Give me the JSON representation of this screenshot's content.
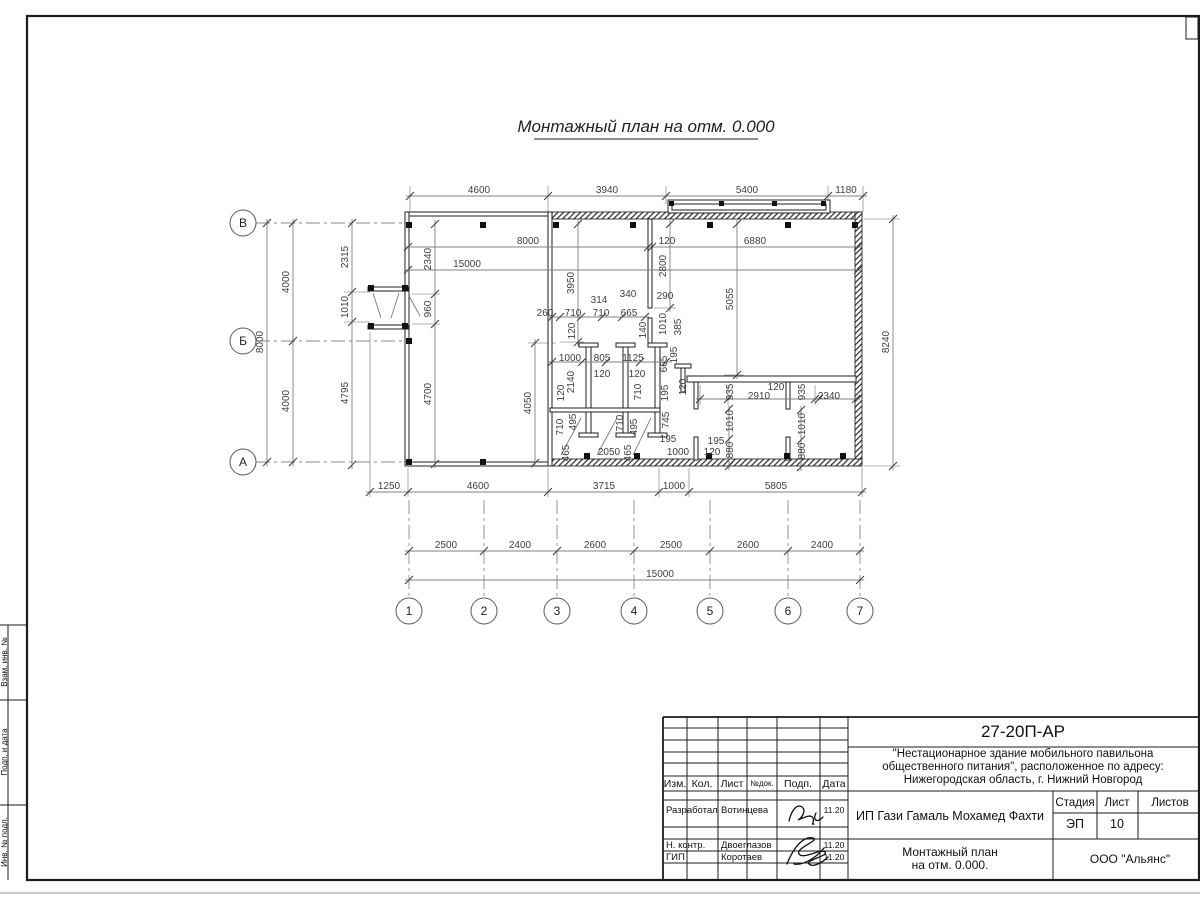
{
  "plan": {
    "title": "Монтажный план на отм. 0.000",
    "row_axes": [
      {
        "label": "В",
        "y": 223
      },
      {
        "label": "Б",
        "y": 341
      },
      {
        "label": "А",
        "y": 462
      }
    ],
    "col_axes": [
      {
        "label": "1",
        "x": 409
      },
      {
        "label": "2",
        "x": 484
      },
      {
        "label": "3",
        "x": 557
      },
      {
        "label": "4",
        "x": 634
      },
      {
        "label": "5",
        "x": 710
      },
      {
        "label": "6",
        "x": 788
      },
      {
        "label": "7",
        "x": 860
      }
    ],
    "h_chains": [
      {
        "y": 196,
        "ticks": [
          410,
          548,
          666,
          828,
          863
        ],
        "labels": [
          {
            "t": "4600",
            "x": 479
          },
          {
            "t": "3940",
            "x": 607
          },
          {
            "t": "5400",
            "x": 747
          },
          {
            "t": "1180",
            "x": 846
          }
        ]
      },
      {
        "y": 247,
        "ticks": [
          408,
          648,
          652,
          858
        ],
        "labels": [
          {
            "t": "8000",
            "x": 528
          },
          {
            "t": "120",
            "x": 667
          },
          {
            "t": "6880",
            "x": 755
          }
        ]
      },
      {
        "y": 270,
        "ticks": [
          408,
          858
        ],
        "labels": [
          {
            "t": "15000",
            "x": 467
          }
        ]
      },
      {
        "y": 317,
        "ticks": [
          552,
          560,
          581,
          602,
          622,
          645
        ],
        "labels": []
      },
      {
        "y": 362,
        "ticks": [
          552,
          582,
          606,
          640,
          666
        ],
        "labels": []
      },
      {
        "y": 399,
        "ticks": [
          700,
          728,
          815,
          819,
          856
        ],
        "labels": []
      },
      {
        "y": 492,
        "ticks": [
          370,
          408,
          548,
          659,
          689,
          862
        ],
        "labels": [
          {
            "t": "1250",
            "x": 389
          },
          {
            "t": "4600",
            "x": 478
          },
          {
            "t": "3715",
            "x": 604
          },
          {
            "t": "1000",
            "x": 674
          },
          {
            "t": "5805",
            "x": 776
          }
        ]
      },
      {
        "y": 551,
        "ticks": [
          409,
          484,
          557,
          634,
          710,
          788,
          860
        ],
        "labels": [
          {
            "t": "2500",
            "x": 446
          },
          {
            "t": "2400",
            "x": 520
          },
          {
            "t": "2600",
            "x": 595
          },
          {
            "t": "2500",
            "x": 671
          },
          {
            "t": "2600",
            "x": 748
          },
          {
            "t": "2400",
            "x": 822
          }
        ]
      },
      {
        "y": 580,
        "ticks": [
          409,
          860
        ],
        "labels": [
          {
            "t": "15000",
            "x": 660
          }
        ]
      }
    ],
    "v_chains": [
      {
        "x": 267,
        "ticks": [
          223,
          462
        ],
        "labels": [
          {
            "t": "8000",
            "y": 342
          }
        ]
      },
      {
        "x": 293,
        "ticks": [
          223,
          341,
          462
        ],
        "labels": [
          {
            "t": "4000",
            "y": 282
          },
          {
            "t": "4000",
            "y": 401
          }
        ]
      },
      {
        "x": 352,
        "ticks": [
          223,
          292,
          322,
          465
        ],
        "labels": [
          {
            "t": "2315",
            "y": 257
          },
          {
            "t": "1010",
            "y": 307
          },
          {
            "t": "4795",
            "y": 393
          }
        ]
      },
      {
        "x": 435,
        "ticks": [
          224,
          294,
          324,
          464
        ],
        "labels": [
          {
            "t": "2340",
            "y": 259
          },
          {
            "t": "960",
            "y": 309
          },
          {
            "t": "4700",
            "y": 394
          }
        ]
      },
      {
        "x": 578,
        "ticks": [
          224,
          342
        ],
        "labels": [
          {
            "t": "3950",
            "y": 283
          }
        ]
      },
      {
        "x": 535,
        "ticks": [
          343,
          463
        ],
        "labels": [
          {
            "t": "4050",
            "y": 403
          }
        ]
      },
      {
        "x": 670,
        "ticks": [
          224,
          308
        ],
        "labels": [
          {
            "t": "2800",
            "y": 266
          }
        ]
      },
      {
        "x": 737,
        "ticks": [
          224,
          375
        ],
        "labels": [
          {
            "t": "5055",
            "y": 299
          }
        ]
      },
      {
        "x": 893,
        "ticks": [
          219,
          466
        ],
        "labels": [
          {
            "t": "8240",
            "y": 342
          }
        ]
      },
      {
        "x": 729,
        "ticks": [
          409,
          439,
          466
        ],
        "labels": []
      },
      {
        "x": 801,
        "ticks": [
          410,
          440,
          467
        ],
        "labels": []
      }
    ],
    "labels": [
      {
        "t": "260",
        "x": 545,
        "y": 313
      },
      {
        "t": "710",
        "x": 573,
        "y": 313
      },
      {
        "t": "710",
        "x": 601,
        "y": 313
      },
      {
        "t": "665",
        "x": 629,
        "y": 313
      },
      {
        "t": "314",
        "x": 599,
        "y": 300
      },
      {
        "t": "340",
        "x": 628,
        "y": 294
      },
      {
        "t": "290",
        "x": 665,
        "y": 296
      },
      {
        "t": "120",
        "x": 575,
        "y": 331,
        "r": 1
      },
      {
        "t": "140",
        "x": 646,
        "y": 330,
        "r": 1
      },
      {
        "t": "1010",
        "x": 666,
        "y": 324,
        "r": 1
      },
      {
        "t": "385",
        "x": 681,
        "y": 327,
        "r": 1
      },
      {
        "t": "1000",
        "x": 570,
        "y": 358
      },
      {
        "t": "805",
        "x": 602,
        "y": 358
      },
      {
        "t": "1125",
        "x": 633,
        "y": 358
      },
      {
        "t": "120",
        "x": 602,
        "y": 374
      },
      {
        "t": "120",
        "x": 637,
        "y": 374
      },
      {
        "t": "195",
        "x": 677,
        "y": 355,
        "r": 1
      },
      {
        "t": "665",
        "x": 667,
        "y": 364,
        "r": 1
      },
      {
        "t": "2140",
        "x": 574,
        "y": 382,
        "r": 1
      },
      {
        "t": "120",
        "x": 564,
        "y": 393,
        "r": 1
      },
      {
        "t": "710",
        "x": 641,
        "y": 392,
        "r": 1
      },
      {
        "t": "195",
        "x": 668,
        "y": 393,
        "r": 1
      },
      {
        "t": "120",
        "x": 686,
        "y": 387,
        "r": 1
      },
      {
        "t": "745",
        "x": 669,
        "y": 420,
        "r": 1
      },
      {
        "t": "495",
        "x": 576,
        "y": 422,
        "r": 1
      },
      {
        "t": "710",
        "x": 563,
        "y": 427,
        "r": 1
      },
      {
        "t": "710",
        "x": 623,
        "y": 423,
        "r": 1
      },
      {
        "t": "495",
        "x": 637,
        "y": 427,
        "r": 1
      },
      {
        "t": "465",
        "x": 569,
        "y": 453,
        "r": 1
      },
      {
        "t": "2050",
        "x": 609,
        "y": 452
      },
      {
        "t": "465",
        "x": 631,
        "y": 453,
        "r": 1
      },
      {
        "t": "195",
        "x": 668,
        "y": 439
      },
      {
        "t": "1000",
        "x": 678,
        "y": 452
      },
      {
        "t": "195",
        "x": 716,
        "y": 441
      },
      {
        "t": "120",
        "x": 712,
        "y": 452
      },
      {
        "t": "935",
        "x": 733,
        "y": 392,
        "r": 1
      },
      {
        "t": "2910",
        "x": 759,
        "y": 396
      },
      {
        "t": "120",
        "x": 776,
        "y": 387
      },
      {
        "t": "935",
        "x": 805,
        "y": 392,
        "r": 1
      },
      {
        "t": "2340",
        "x": 829,
        "y": 396
      },
      {
        "t": "1010",
        "x": 733,
        "y": 421,
        "r": 1
      },
      {
        "t": "880",
        "x": 733,
        "y": 450,
        "r": 1
      },
      {
        "t": "1010",
        "x": 805,
        "y": 424,
        "r": 1
      },
      {
        "t": "880",
        "x": 805,
        "y": 451,
        "r": 1
      }
    ]
  },
  "sheet": {
    "doc_number": "27-20П-АР",
    "project_line1": "\"Нестационарное здание мобильного павильона",
    "project_line2": "общественного питания\", расположенное по адресу:",
    "project_line3": "Нижегородская область, г. Нижний Новгород",
    "client": "ИП Гази Гамаль Мохамед Фахти",
    "stage_label": "Стадия",
    "sheet_label": "Лист",
    "sheets_label": "Листов",
    "stage_value": "ЭП",
    "sheet_value": "10",
    "drawing_name_line1": "Монтажный план",
    "drawing_name_line2": "на отм. 0.000.",
    "company": "ООО \"Альянс\"",
    "header_cols": [
      "Изм.",
      "Кол.",
      "Лист",
      "№док.",
      "Подп.",
      "Дата"
    ],
    "rows": [
      {
        "role": "Разработал",
        "name": "Вотинцева",
        "date": "11.20"
      },
      {
        "role": "Н. контр.",
        "name": "Двоеглазов",
        "date": "11.20"
      },
      {
        "role": "ГИП",
        "name": "Коротаев",
        "date": "11.20"
      }
    ],
    "side_labels": [
      "Взам. инв. №",
      "Подп. и дата",
      "Инв. № подл."
    ]
  }
}
